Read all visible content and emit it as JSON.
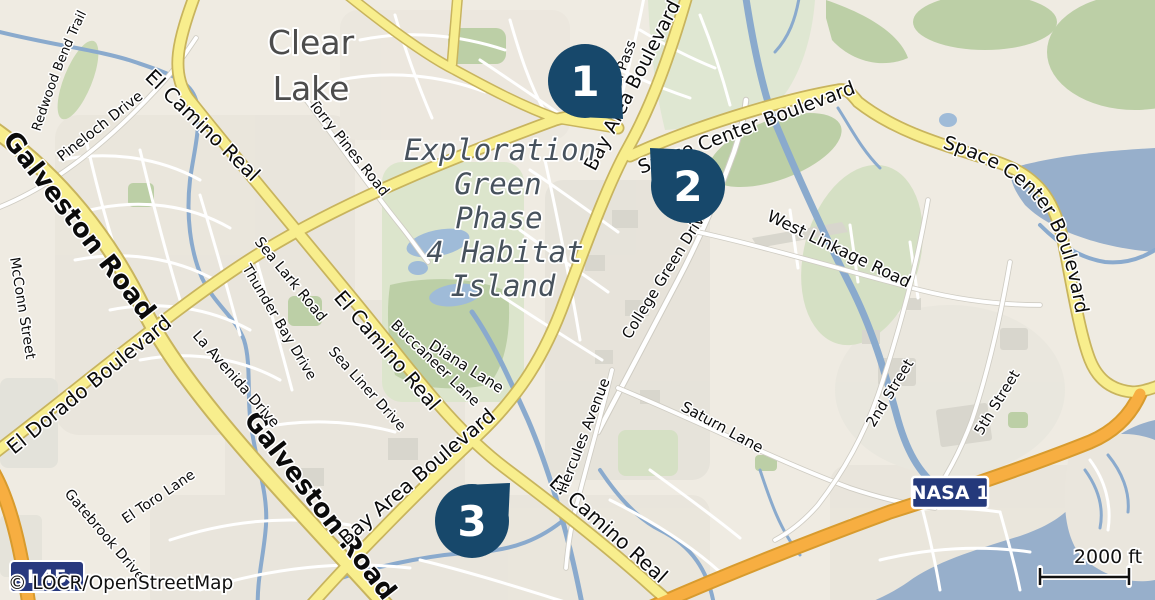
{
  "map_type": "street-map",
  "attribution": "© LOCR/OpenStreetMap",
  "scale_bar": {
    "label": "2000 ft"
  },
  "place_labels": {
    "clear_lake": {
      "line1": "Clear",
      "line2": "Lake"
    },
    "exploration_green": {
      "line1": "Exploration",
      "line2": "Green",
      "line3": "Phase",
      "line4": "4 Habitat",
      "line5": "Island"
    }
  },
  "markers": {
    "m1": "1",
    "m2": "2",
    "m3": "3"
  },
  "route_shields": {
    "nasa1": "NASA 1",
    "i45": "I 45"
  },
  "streets": {
    "galveston": "Galveston Road",
    "el_camino": "El Camino Real",
    "bay_area": "Bay Area Boulevard",
    "el_dorado": "El Dorado Boulevard",
    "space_center": "Space Center Boulevard",
    "west_linkage": "West Linkage Road",
    "college_green": "College Green Drive",
    "saturn": "Saturn Lane",
    "hercules": "Hercules Avenue",
    "on_pass": "on Pass",
    "diana": "Diana Lane",
    "buccaneer": "Buccaneer Lane",
    "sea_lark": "Sea Lark Road",
    "thunder_bay": "Thunder Bay Drive",
    "sea_liner": "Sea Liner Drive",
    "la_avenida": "La Avenida Drive",
    "el_toro": "El Toro Lane",
    "gatebrook": "Gatebrook Drive",
    "mcconn": "McConn Street",
    "pineloch": "Pineloch Drive",
    "redwood": "Redwood Bend Trail",
    "torry_pines": "Torry Pines Road",
    "second_street": "2nd Street",
    "fifth_street": "5th Street"
  },
  "colors": {
    "marker": "#17486B",
    "water": "#97AFCB",
    "road_yellow": "#F8EE8D",
    "road_orange": "#F7AE41",
    "green_area": "#BCCFA6",
    "land": "#EFEBE2",
    "shield_blue": "#28397E"
  }
}
